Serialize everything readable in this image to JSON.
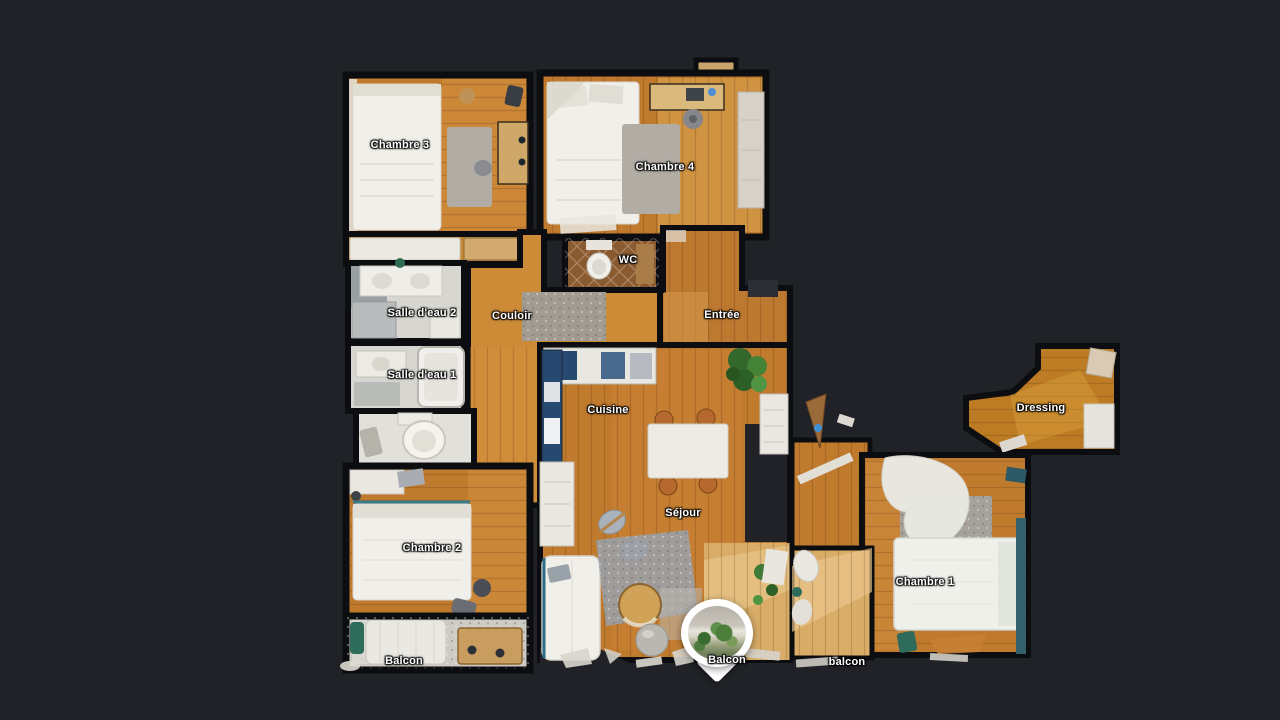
{
  "app": {
    "view_name": "floorplan"
  },
  "palette": {
    "background": "#202227",
    "wall": "#0c0d10",
    "wood": "#c07a2e",
    "wood_light": "#d89a47",
    "deck": "#d9ad67",
    "tile": "#d8d6d1",
    "bed": "#f1efe9",
    "rug": "#b1ada5",
    "rug_blue": "#9aa0a6",
    "counter_blue": "#27496f",
    "plant": "#3f7a38",
    "balcony_floor": "#cecbc4",
    "marker_white": "#ffffff",
    "label_text": "#ffffff"
  },
  "rooms": [
    {
      "id": "chambre-3",
      "label": "Chambre 3"
    },
    {
      "id": "chambre-4",
      "label": "Chambre 4"
    },
    {
      "id": "wc",
      "label": "WC"
    },
    {
      "id": "salle-deau-2",
      "label": "Salle d'eau 2"
    },
    {
      "id": "couloir",
      "label": "Couloir"
    },
    {
      "id": "entree",
      "label": "Entrée"
    },
    {
      "id": "salle-deau-1",
      "label": "Salle d'eau 1"
    },
    {
      "id": "cuisine",
      "label": "Cuisine"
    },
    {
      "id": "dressing",
      "label": "Dressing"
    },
    {
      "id": "chambre-2",
      "label": "Chambre 2"
    },
    {
      "id": "sejour",
      "label": "Séjour"
    },
    {
      "id": "chambre-1",
      "label": "Chambre 1"
    },
    {
      "id": "balcon-left",
      "label": "Balcon"
    },
    {
      "id": "balcon-center",
      "label": "Balcon"
    },
    {
      "id": "balcon-right",
      "label": "balcon"
    }
  ],
  "marker": {
    "icon": "panorama-pin"
  }
}
